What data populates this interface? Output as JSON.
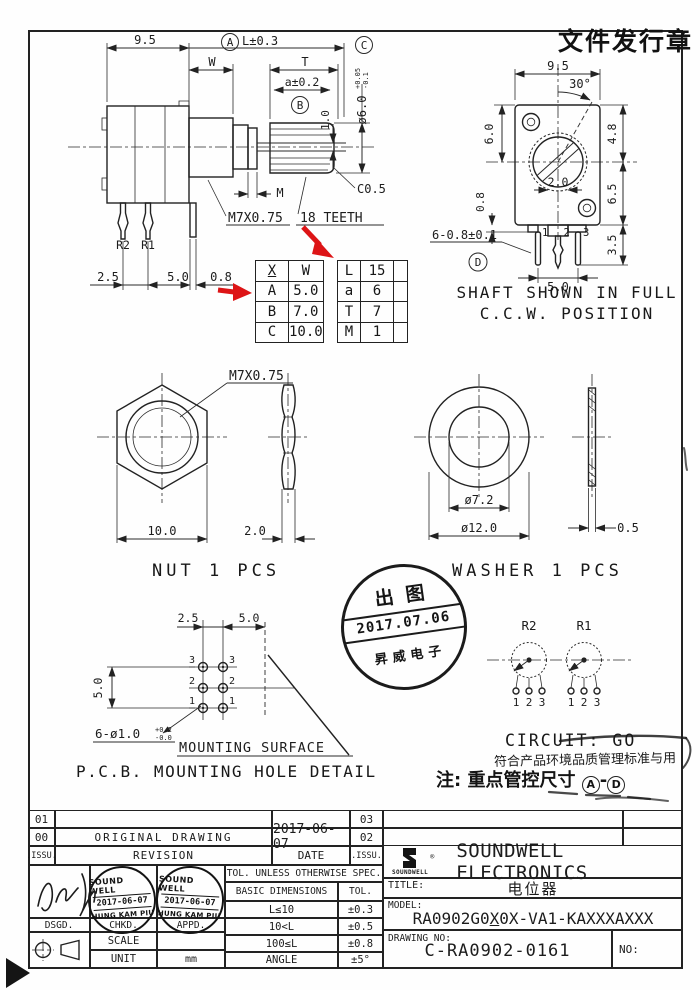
{
  "header": {
    "release_stamp": "文件发行章"
  },
  "side_view": {
    "dim_95": "9.5",
    "label_a": "A",
    "dim_l": "L±0.3",
    "dim_w": "W",
    "dim_t": "T",
    "dim_a": "a±0.2",
    "label_b": "B",
    "dim_slot": "1.0",
    "dia6": "ø6.0",
    "dia6_up": "+0.05",
    "dia6_dn": "-0.1",
    "label_c": "C",
    "chamfer": "C0.5",
    "thread": "M7X0.75",
    "teeth": "18 TEETH",
    "dim_m": "M",
    "pin_r2": "R2",
    "pin_r1": "R1",
    "dim_25": "2.5",
    "dim_50": "5.0",
    "dim_08": "0.8"
  },
  "front_view": {
    "dim_95": "9.5",
    "dim_angle": "30°",
    "dim_48": "4.8",
    "dim_60": "6.0",
    "dim_65": "6.5",
    "dim_20": "2.0",
    "dim_08": "0.8",
    "dim_35": "3.5",
    "dim_pin": "6-0.8±0.1",
    "label_d": "D",
    "dim_50": "5.0",
    "pin_labels": [
      "1",
      "2",
      "3"
    ],
    "caption1": "SHAFT SHOWN IN FULL",
    "caption2": "C.C.W. POSITION"
  },
  "size_table": {
    "head_x": "X",
    "head_w": "W",
    "rows": [
      [
        "A",
        "5.0"
      ],
      [
        "B",
        "7.0"
      ],
      [
        "C",
        "10.0"
      ]
    ]
  },
  "param_table": {
    "rows": [
      [
        "L",
        "15"
      ],
      [
        "a",
        "6"
      ],
      [
        "T",
        "7"
      ],
      [
        "M",
        "1"
      ]
    ]
  },
  "nut": {
    "thread": "M7X0.75",
    "dim_width": "10.0",
    "dim_thick": "2.0",
    "caption": "NUT 1 PCS"
  },
  "washer": {
    "dia_in": "ø7.2",
    "dia_out": "ø12.0",
    "dim_thick": "0.5",
    "caption": "WASHER 1 PCS"
  },
  "release_stamp": {
    "line1": "出图",
    "line2": "2017.07.06",
    "line3": "昇威电子"
  },
  "pcb": {
    "dim_25": "2.5",
    "dim_50_top": "5.0",
    "dim_50_left": "5.0",
    "hole_note": "6-ø1.0",
    "tol_up": "+0.2",
    "tol_dn": "-0.0",
    "surface": "MOUNTING SURFACE",
    "caption": "P.C.B. MOUNTING HOLE DETAIL",
    "row_labels": [
      "3",
      "2",
      "1"
    ]
  },
  "circuit": {
    "r2": "R2",
    "r1": "R1",
    "terminals": [
      "1",
      "2",
      "3"
    ],
    "caption": "CIRCUIT: GO"
  },
  "notes": {
    "line1": "符合产品环境品质管理标准与用",
    "line2_prefix": "注: 重点管控尺寸",
    "circle_a": "A",
    "dash": "-",
    "circle_d": "D"
  },
  "revision_table": {
    "rows": [
      [
        "01",
        "",
        "",
        "03"
      ],
      [
        "00",
        "ORIGINAL DRAWING",
        "2017-06-07",
        "02"
      ],
      [
        ".ISSU.",
        "REVISION",
        "DATE",
        ".ISSU."
      ]
    ]
  },
  "approval": {
    "dsgd": "DSGD.",
    "chkd": "CHKD.",
    "appd": "APPD.",
    "stamp": {
      "line1": "SOUND WELL",
      "line2": "2017-06-07",
      "line3": "HUNG KAM PIU"
    },
    "scale_label": "SCALE",
    "scale_value": "",
    "unit_label": "UNIT",
    "unit_value": "mm"
  },
  "tolerance": {
    "header": "TOL. UNLESS OTHERWISE SPEC.",
    "col1": "BASIC DIMENSIONS",
    "col2": "TOL.",
    "rows": [
      [
        "L≤10",
        "±0.3"
      ],
      [
        "10<L",
        "±0.5"
      ],
      [
        "100≤L",
        "±0.8"
      ],
      [
        "ANGLE",
        "±5°"
      ]
    ]
  },
  "company": {
    "logo_text": "SOUNDWELL",
    "reg": "®",
    "name": "SOUNDWELL ELECTRONICS",
    "title_label": "TITLE:",
    "title_value": "电位器",
    "model_label": "MODEL:",
    "model_prefix": "RA0902G0",
    "model_x": "X",
    "model_suffix": "0X-VA1-KAXXXAXXX",
    "drawing_label": "DRAWING NO:",
    "drawing_value": "C-RA0902-0161",
    "no_label": "NO:"
  }
}
